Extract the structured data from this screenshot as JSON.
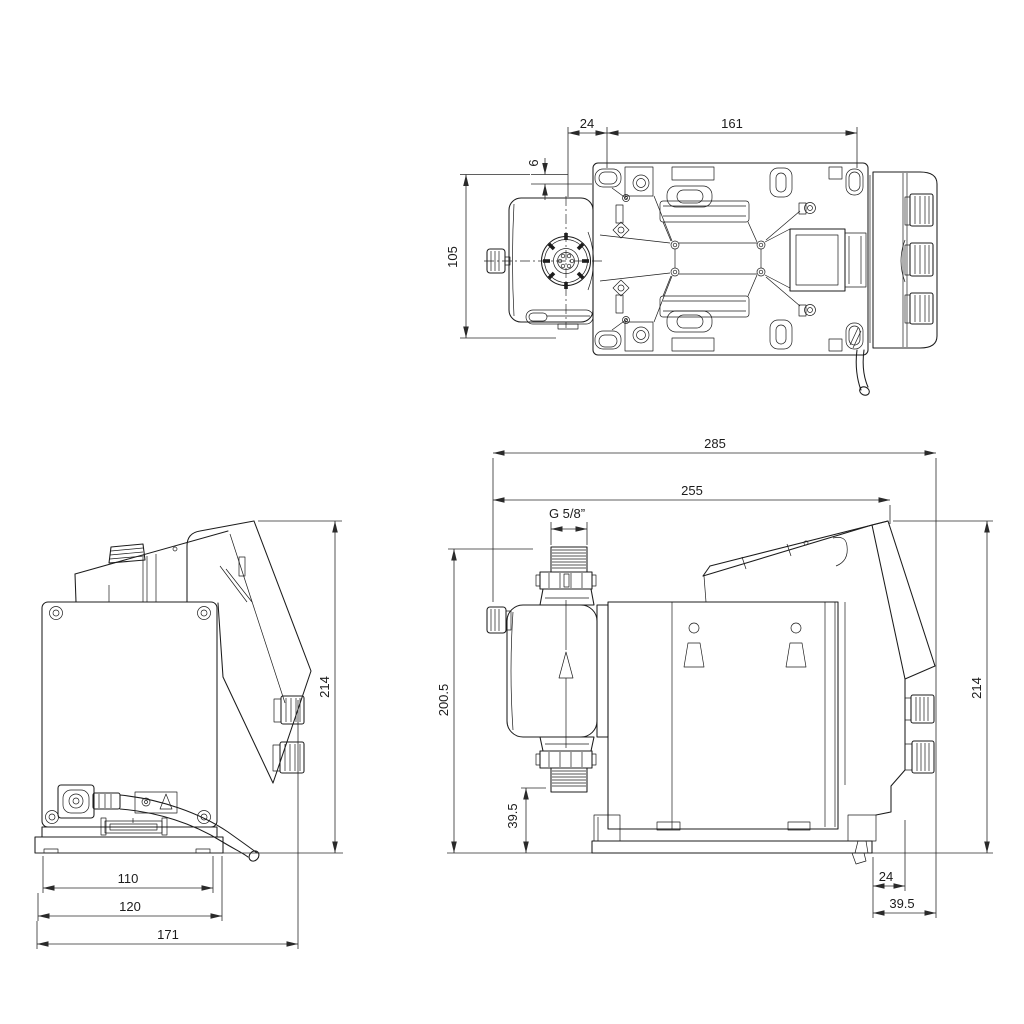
{
  "page": {
    "title": "dosing-pump-dimensional-drawing",
    "background": "#ffffff",
    "line_color": "#1c1c1c",
    "dim_color": "#2a2a2a"
  },
  "views": {
    "top": {
      "label": "top-view",
      "dims": {
        "w24": "24",
        "w161": "161",
        "h6": "6",
        "h105": "105"
      }
    },
    "back": {
      "label": "back-view",
      "dims": {
        "w110": "110",
        "w120": "120",
        "w171": "171",
        "h214": "214"
      }
    },
    "side": {
      "label": "side-view",
      "dims": {
        "w285": "285",
        "w255": "255",
        "thread": "G 5/8”",
        "h200_5": "200.5",
        "h39_5": "39.5",
        "h214": "214",
        "w24": "24",
        "w39_5": "39.5"
      }
    }
  }
}
